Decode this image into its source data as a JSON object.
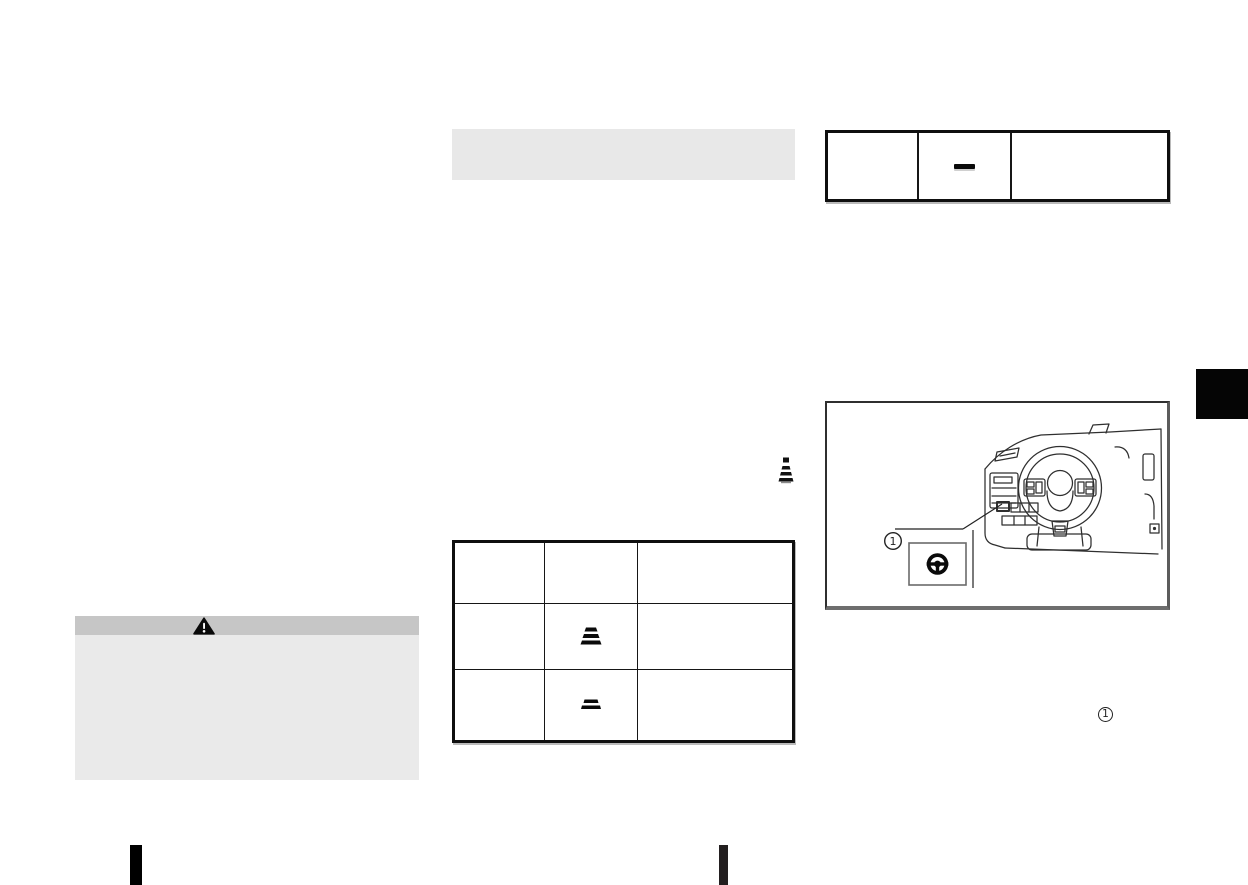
{
  "page": {
    "kind": "owners-manual-scanned-page",
    "background": "#ffffff",
    "ink_color": "#111111"
  },
  "section_heading_bar": {
    "text": "",
    "bg_color": "#e8e8e8"
  },
  "top_right_table": {
    "border_color": "#0f0f0f",
    "rows": [
      {
        "col1": "",
        "col2_symbol": "dash-symbol",
        "col3": ""
      }
    ]
  },
  "middle_table": {
    "border_color": "#0f0f0f",
    "rows": [
      {
        "col1": "",
        "col2": "",
        "col3": ""
      },
      {
        "col1": "",
        "col2_symbol": "heat-level-high-symbol",
        "col3": ""
      },
      {
        "col1": "",
        "col2_symbol": "heat-level-low-symbol",
        "col3": ""
      }
    ]
  },
  "warning_box": {
    "header_bg": "#c6c6c6",
    "body_bg": "#eaeaea",
    "icon": "warning-triangle-icon",
    "title": "",
    "body_text": ""
  },
  "inline_symbol": {
    "name": "heat-indicator-icon"
  },
  "figure": {
    "border_color": "#2f2f2f",
    "illustration": "dashboard-steering-wheel-line-art",
    "callout_label": "1",
    "callout_icon": "heated-steering-wheel-button-icon"
  },
  "footnote_marker": {
    "label": "1"
  },
  "chapter_tab": {
    "bg_color": "#050505"
  },
  "bottom_markers": [
    {
      "color": "#000000"
    },
    {
      "color": "#231f20"
    }
  ]
}
